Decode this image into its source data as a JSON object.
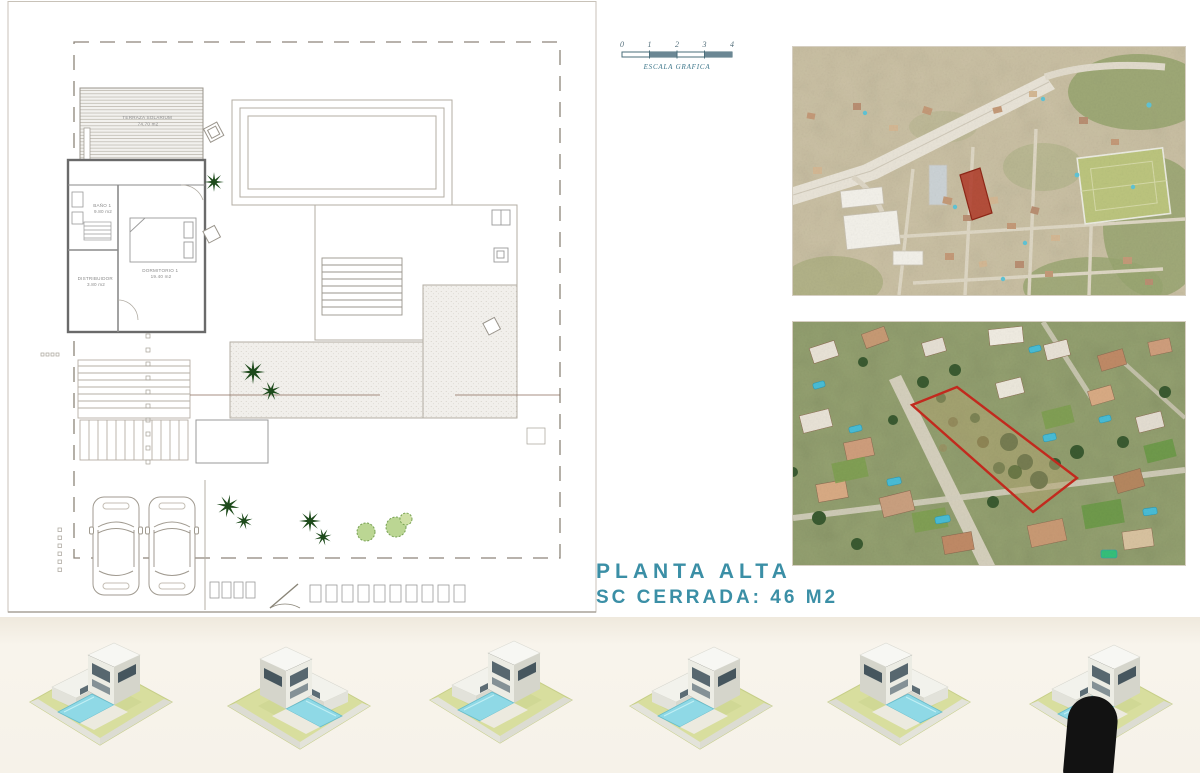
{
  "colors": {
    "accent_teal": "#3b8fa6",
    "plot_outline_red": "#c52a1e",
    "site_marker_red": "#b03a28"
  },
  "title": {
    "line1": "PLANTA ALTA",
    "line2": "SC CERRADA: 46 M2"
  },
  "scale_bar": {
    "ticks": [
      "0",
      "1",
      "2",
      "3",
      "4"
    ],
    "label": "ESCALA GRAFICA"
  },
  "floor_plan": {
    "rooms": [
      {
        "name": "TERRAZA SOLARIUM",
        "area": "74.70 m2"
      },
      {
        "name": "BAÑO 1",
        "area": "9.80 m2"
      },
      {
        "name": "DORMITORIO 1",
        "area": "19.40 m2"
      },
      {
        "name": "DISTRIBUIDOR",
        "area": "3.80 m2"
      }
    ]
  }
}
